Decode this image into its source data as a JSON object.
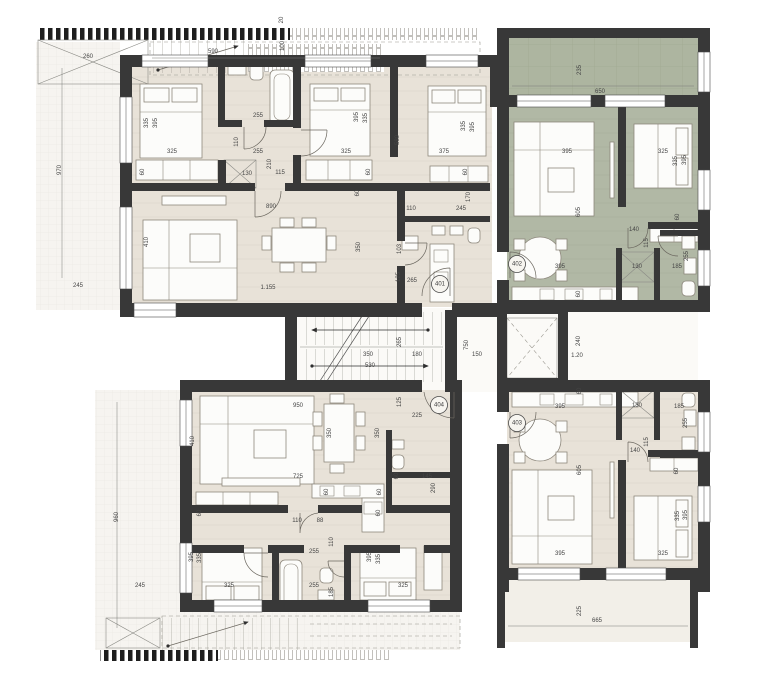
{
  "drawing": {
    "type": "architectural-floor-plan",
    "units_shown": [
      "401",
      "402",
      "403",
      "404"
    ]
  },
  "colors": {
    "wall": "#383838",
    "floor_beige": "#e8e2d8",
    "floor_green": "#b1b8a5",
    "balcony_green": "#adb5a0",
    "terrace_light": "#f6f4f0",
    "dim_text": "#454545"
  },
  "unit_badges": [
    {
      "label": "401",
      "x": 440,
      "y": 284
    },
    {
      "label": "402",
      "x": 517,
      "y": 264
    },
    {
      "label": "403",
      "x": 517,
      "y": 423
    },
    {
      "label": "404",
      "x": 439,
      "y": 405
    }
  ],
  "labels": [
    {
      "t": "260",
      "x": 88,
      "y": 57,
      "r": 0
    },
    {
      "t": "590",
      "x": 213,
      "y": 52,
      "r": 0
    },
    {
      "t": "20",
      "x": 282,
      "y": 20,
      "r": 1
    },
    {
      "t": "100",
      "x": 283,
      "y": 46,
      "r": 1
    },
    {
      "t": "970",
      "x": 60,
      "y": 170,
      "r": 1
    },
    {
      "t": "245",
      "x": 78,
      "y": 286,
      "r": 0
    },
    {
      "t": "960",
      "x": 117,
      "y": 517,
      "r": 1
    },
    {
      "t": "245",
      "x": 140,
      "y": 586,
      "r": 0
    },
    {
      "t": "225",
      "x": 580,
      "y": 611,
      "r": 1
    },
    {
      "t": "665",
      "x": 597,
      "y": 621,
      "r": 0
    },
    {
      "t": "235",
      "x": 580,
      "y": 70,
      "r": 1
    },
    {
      "t": "650",
      "x": 600,
      "y": 92,
      "r": 0
    },
    {
      "t": "335",
      "x": 147,
      "y": 123,
      "r": 1
    },
    {
      "t": "395",
      "x": 156,
      "y": 123,
      "r": 1
    },
    {
      "t": "325",
      "x": 172,
      "y": 152,
      "r": 0
    },
    {
      "t": "60",
      "x": 143,
      "y": 172,
      "r": 1
    },
    {
      "t": "110",
      "x": 237,
      "y": 142,
      "r": 1
    },
    {
      "t": "255",
      "x": 258,
      "y": 116,
      "r": 0
    },
    {
      "t": "255",
      "x": 258,
      "y": 152,
      "r": 0
    },
    {
      "t": "210",
      "x": 270,
      "y": 164,
      "r": 1
    },
    {
      "t": "130",
      "x": 247,
      "y": 174,
      "r": 0
    },
    {
      "t": "115",
      "x": 280,
      "y": 173,
      "r": 0
    },
    {
      "t": "395",
      "x": 357,
      "y": 117,
      "r": 1
    },
    {
      "t": "335",
      "x": 366,
      "y": 118,
      "r": 1
    },
    {
      "t": "325",
      "x": 346,
      "y": 152,
      "r": 0
    },
    {
      "t": "580",
      "x": 398,
      "y": 140,
      "r": 1
    },
    {
      "t": "60",
      "x": 369,
      "y": 172,
      "r": 1
    },
    {
      "t": "335",
      "x": 464,
      "y": 126,
      "r": 1
    },
    {
      "t": "395",
      "x": 473,
      "y": 127,
      "r": 1
    },
    {
      "t": "375",
      "x": 444,
      "y": 152,
      "r": 0
    },
    {
      "t": "60",
      "x": 466,
      "y": 172,
      "r": 1
    },
    {
      "t": "170",
      "x": 469,
      "y": 197,
      "r": 1
    },
    {
      "t": "245",
      "x": 461,
      "y": 209,
      "r": 0
    },
    {
      "t": "110",
      "x": 411,
      "y": 209,
      "r": 0
    },
    {
      "t": "103",
      "x": 400,
      "y": 249,
      "r": 1
    },
    {
      "t": "125",
      "x": 399,
      "y": 277,
      "r": 1
    },
    {
      "t": "265",
      "x": 412,
      "y": 281,
      "r": 0
    },
    {
      "t": "890",
      "x": 271,
      "y": 207,
      "r": 0
    },
    {
      "t": "410",
      "x": 147,
      "y": 242,
      "r": 1
    },
    {
      "t": "350",
      "x": 359,
      "y": 247,
      "r": 1
    },
    {
      "t": "1.155",
      "x": 268,
      "y": 288,
      "r": 0
    },
    {
      "t": "60",
      "x": 358,
      "y": 193,
      "r": 1
    },
    {
      "t": "395",
      "x": 567,
      "y": 152,
      "r": 0
    },
    {
      "t": "605",
      "x": 579,
      "y": 212,
      "r": 1
    },
    {
      "t": "395",
      "x": 560,
      "y": 267,
      "r": 0
    },
    {
      "t": "60",
      "x": 579,
      "y": 294,
      "r": 1
    },
    {
      "t": "325",
      "x": 663,
      "y": 152,
      "r": 0
    },
    {
      "t": "335",
      "x": 676,
      "y": 161,
      "r": 1
    },
    {
      "t": "395",
      "x": 685,
      "y": 160,
      "r": 1
    },
    {
      "t": "60",
      "x": 678,
      "y": 217,
      "r": 1
    },
    {
      "t": "140",
      "x": 634,
      "y": 230,
      "r": 0
    },
    {
      "t": "115",
      "x": 647,
      "y": 243,
      "r": 1
    },
    {
      "t": "130",
      "x": 637,
      "y": 267,
      "r": 0
    },
    {
      "t": "185",
      "x": 677,
      "y": 267,
      "r": 0
    },
    {
      "t": "255",
      "x": 687,
      "y": 256,
      "r": 1
    },
    {
      "t": "350",
      "x": 368,
      "y": 355,
      "r": 0
    },
    {
      "t": "530",
      "x": 370,
      "y": 366,
      "r": 0
    },
    {
      "t": "265",
      "x": 400,
      "y": 342,
      "r": 1
    },
    {
      "t": "180",
      "x": 417,
      "y": 355,
      "r": 0
    },
    {
      "t": "750",
      "x": 467,
      "y": 345,
      "r": 1
    },
    {
      "t": "150",
      "x": 477,
      "y": 355,
      "r": 0
    },
    {
      "t": "125",
      "x": 400,
      "y": 402,
      "r": 1
    },
    {
      "t": "225",
      "x": 417,
      "y": 416,
      "r": 0
    },
    {
      "t": "240",
      "x": 579,
      "y": 341,
      "r": 1
    },
    {
      "t": "1.20",
      "x": 577,
      "y": 356,
      "r": 0
    },
    {
      "t": "950",
      "x": 298,
      "y": 406,
      "r": 0
    },
    {
      "t": "410",
      "x": 193,
      "y": 441,
      "r": 1
    },
    {
      "t": "350",
      "x": 330,
      "y": 433,
      "r": 1
    },
    {
      "t": "350",
      "x": 378,
      "y": 433,
      "r": 1
    },
    {
      "t": "725",
      "x": 298,
      "y": 477,
      "r": 0
    },
    {
      "t": "60",
      "x": 200,
      "y": 513,
      "r": 1
    },
    {
      "t": "110",
      "x": 297,
      "y": 521,
      "r": 0
    },
    {
      "t": "88",
      "x": 320,
      "y": 521,
      "r": 0
    },
    {
      "t": "110",
      "x": 332,
      "y": 542,
      "r": 1
    },
    {
      "t": "255",
      "x": 314,
      "y": 552,
      "r": 0
    },
    {
      "t": "60",
      "x": 327,
      "y": 492,
      "r": 1
    },
    {
      "t": "60",
      "x": 380,
      "y": 492,
      "r": 1
    },
    {
      "t": "60",
      "x": 379,
      "y": 513,
      "r": 1
    },
    {
      "t": "145",
      "x": 427,
      "y": 477,
      "r": 0
    },
    {
      "t": "60",
      "x": 397,
      "y": 476,
      "r": 1
    },
    {
      "t": "290",
      "x": 434,
      "y": 488,
      "r": 1
    },
    {
      "t": "395",
      "x": 192,
      "y": 557,
      "r": 1
    },
    {
      "t": "335",
      "x": 200,
      "y": 558,
      "r": 1
    },
    {
      "t": "325",
      "x": 229,
      "y": 586,
      "r": 0
    },
    {
      "t": "255",
      "x": 314,
      "y": 586,
      "r": 0
    },
    {
      "t": "185",
      "x": 332,
      "y": 592,
      "r": 1
    },
    {
      "t": "395",
      "x": 370,
      "y": 557,
      "r": 1
    },
    {
      "t": "335",
      "x": 379,
      "y": 559,
      "r": 1
    },
    {
      "t": "325",
      "x": 403,
      "y": 586,
      "r": 0
    },
    {
      "t": "395",
      "x": 560,
      "y": 407,
      "r": 0
    },
    {
      "t": "60",
      "x": 580,
      "y": 391,
      "r": 1
    },
    {
      "t": "130",
      "x": 637,
      "y": 406,
      "r": 0
    },
    {
      "t": "185",
      "x": 679,
      "y": 407,
      "r": 0
    },
    {
      "t": "255",
      "x": 686,
      "y": 423,
      "r": 1
    },
    {
      "t": "140",
      "x": 635,
      "y": 451,
      "r": 0
    },
    {
      "t": "115",
      "x": 647,
      "y": 442,
      "r": 1
    },
    {
      "t": "605",
      "x": 580,
      "y": 470,
      "r": 1
    },
    {
      "t": "60",
      "x": 677,
      "y": 471,
      "r": 1
    },
    {
      "t": "395",
      "x": 560,
      "y": 554,
      "r": 0
    },
    {
      "t": "325",
      "x": 663,
      "y": 554,
      "r": 0
    },
    {
      "t": "335",
      "x": 678,
      "y": 516,
      "r": 1
    },
    {
      "t": "395",
      "x": 686,
      "y": 515,
      "r": 1
    }
  ]
}
